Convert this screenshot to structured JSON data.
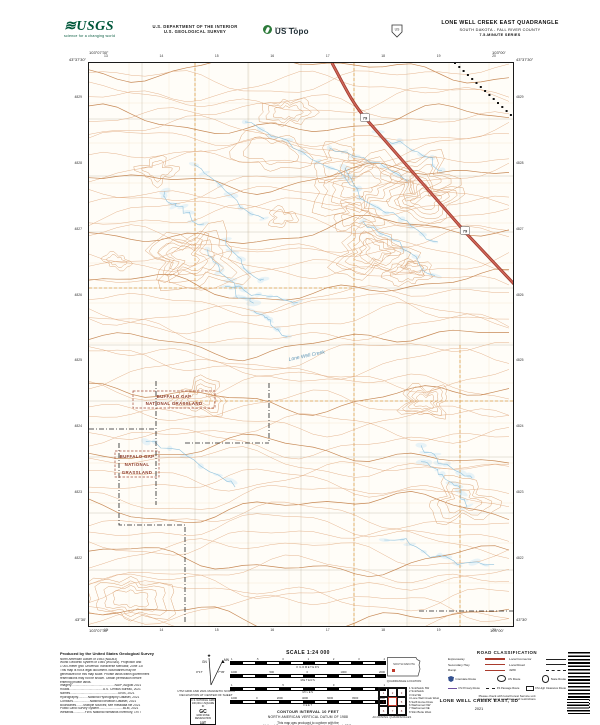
{
  "header": {
    "usgs_logo": {
      "brand": "USGS",
      "tagline": "science for a changing world"
    },
    "dept_line1": "U.S. DEPARTMENT OF THE INTERIOR",
    "dept_line2": "U.S. GEOLOGICAL SURVEY",
    "ustopo": {
      "program": "The National Map",
      "brand": "US Topo"
    },
    "quad_title": "LONE WELL CREEK EAST QUADRANGLE",
    "quad_subtitle": "SOUTH DAKOTA - FALL RIVER COUNTY",
    "quad_series": "7.5-MINUTE SERIES"
  },
  "map": {
    "corners": {
      "tl_lat": "43°37'30\"",
      "tl_lon": "103°07'30\"",
      "tr_lat": "43°37'30\"",
      "tr_lon": "103°00'",
      "bl_lat": "43°30'",
      "bl_lon": "103°07'30\"",
      "br_lat": "43°30'",
      "br_lon": "103°00'"
    },
    "top_ticks": [
      "13",
      "14",
      "15",
      "16",
      "17",
      "18",
      "19",
      "20"
    ],
    "bottom_ticks": [
      "13",
      "14",
      "15",
      "16",
      "17",
      "18",
      "19",
      "20"
    ],
    "left_ticks": [
      "4829",
      "4828",
      "4827",
      "4826",
      "4825",
      "4824",
      "4823",
      "4822"
    ],
    "right_ticks": [
      "4829",
      "4828",
      "4827",
      "4826",
      "4825",
      "4824",
      "4823",
      "4822"
    ],
    "grassland_label_1": [
      "BUFFALO GAP",
      "NATIONAL GRASSLAND"
    ],
    "grassland_label_2": [
      "BUFFALO GAP",
      "NATIONAL",
      "GRASSLAND"
    ],
    "route_shield": "79",
    "creek_label": "Lone Well Creek",
    "colors": {
      "contour": "#e0a87c",
      "contour_index": "#c4844e",
      "water": "#8cc0dc",
      "highway": "#a03a2e",
      "grassland_text": "#8d3b2b"
    }
  },
  "footer": {
    "credits": {
      "title": "Produced by the United States Geological Survey",
      "lines": [
        "North American Datum of 1983 (NAD83)",
        "World Geodetic System of 1984 (WGS84). Projection and",
        "1 000-meter grid: Universal Transverse Mercator, Zone 13T",
        "This map is not a legal document. Boundaries may be",
        "generalized for this map scale. Private lands within government",
        "reservations may not be shown. Obtain permission before",
        "entering private lands.",
        "Imagery.................................................NAIP, August 2021",
        "Roads......................................U.S. Census Bureau, 2021",
        "Names......................................................GNIS, 2021",
        "Hydrography...........National Hydrography Dataset, 2021",
        "Contours...................National Elevation Dataset, 2021",
        "Boundaries........Multiple sources; see metadata file 2021",
        "Public Land Survey System...........................BLM, 2021",
        "Wetlands.............FWS National Wetlands Inventory, 1977"
      ]
    },
    "declination": {
      "gn": "GN",
      "mn": "MN",
      "gn_value": "0°17'",
      "mn_value": "7°45'",
      "caption1": "UTM GRID AND 2021 MAGNETIC NORTH",
      "caption2": "DECLINATION AT CENTER OF SHEET"
    },
    "usng": {
      "title": "U.S. NATIONAL GRID",
      "sub": "100,000-m SQUARE ID",
      "square": "GC",
      "zone_label": "GRID ZONE DESIGNATION",
      "zone": "13T"
    },
    "scale": {
      "title": "SCALE 1:24 000",
      "bars": [
        {
          "unit": "KILOMETERS",
          "ticks": [
            "1",
            ".5",
            "0",
            "1",
            "2",
            "3",
            "4"
          ]
        },
        {
          "unit": "METERS",
          "ticks": [
            "1000",
            "500",
            "0",
            "1000",
            "2000"
          ]
        },
        {
          "unit": "MILES",
          "ticks": [
            "1",
            ".5",
            "0",
            "1"
          ]
        },
        {
          "unit": "FEET",
          "ticks": [
            "1000",
            "0",
            "2000",
            "4000",
            "6000",
            "8000",
            "10000"
          ]
        }
      ],
      "contour_note1": "CONTOUR INTERVAL 10 FEET",
      "contour_note2": "NORTH AMERICAN VERTICAL DATUM OF 1988",
      "standard_note1": "This map was produced to conform with the",
      "standard_note2": "National Geospatial Program US Topo Product Standard, 2011."
    },
    "location": {
      "state_label": "SOUTH DAKOTA",
      "caption": "QUADRANGLE LOCATION"
    },
    "adjoining": {
      "cells": [
        "1",
        "2",
        "3",
        "4",
        "5",
        "6",
        "7",
        "8"
      ],
      "names": [
        "1 Smithwick SW",
        "2 Smithwick",
        "3 Oral SE",
        "4 Lone Well Creek West",
        "5 Swift Horse Draw",
        "6 Warbonnet NW",
        "7 Warbonnet NE",
        "8 Slim Butte West"
      ],
      "caption": "ADJOINING QUADRANGLES"
    },
    "road_class": {
      "title": "ROAD CLASSIFICATION",
      "rows": [
        {
          "l": "Expressway",
          "r": "Local Connector"
        },
        {
          "l": "Secondary Hwy",
          "r": "Local Road"
        },
        {
          "l": "Ramp",
          "r": "4WD"
        }
      ],
      "shields": [
        "Interstate Route",
        "US Route",
        "State Route"
      ],
      "fs": [
        "FS Primary Route",
        "FS Passage Route",
        "FS High Clearance Route"
      ],
      "note1": "Please check with local Forest Service unit",
      "note2": "for current travel conditions and restrictions"
    },
    "sheet": {
      "name": "LONE WELL CREEK EAST, SD",
      "year": "2021"
    }
  }
}
